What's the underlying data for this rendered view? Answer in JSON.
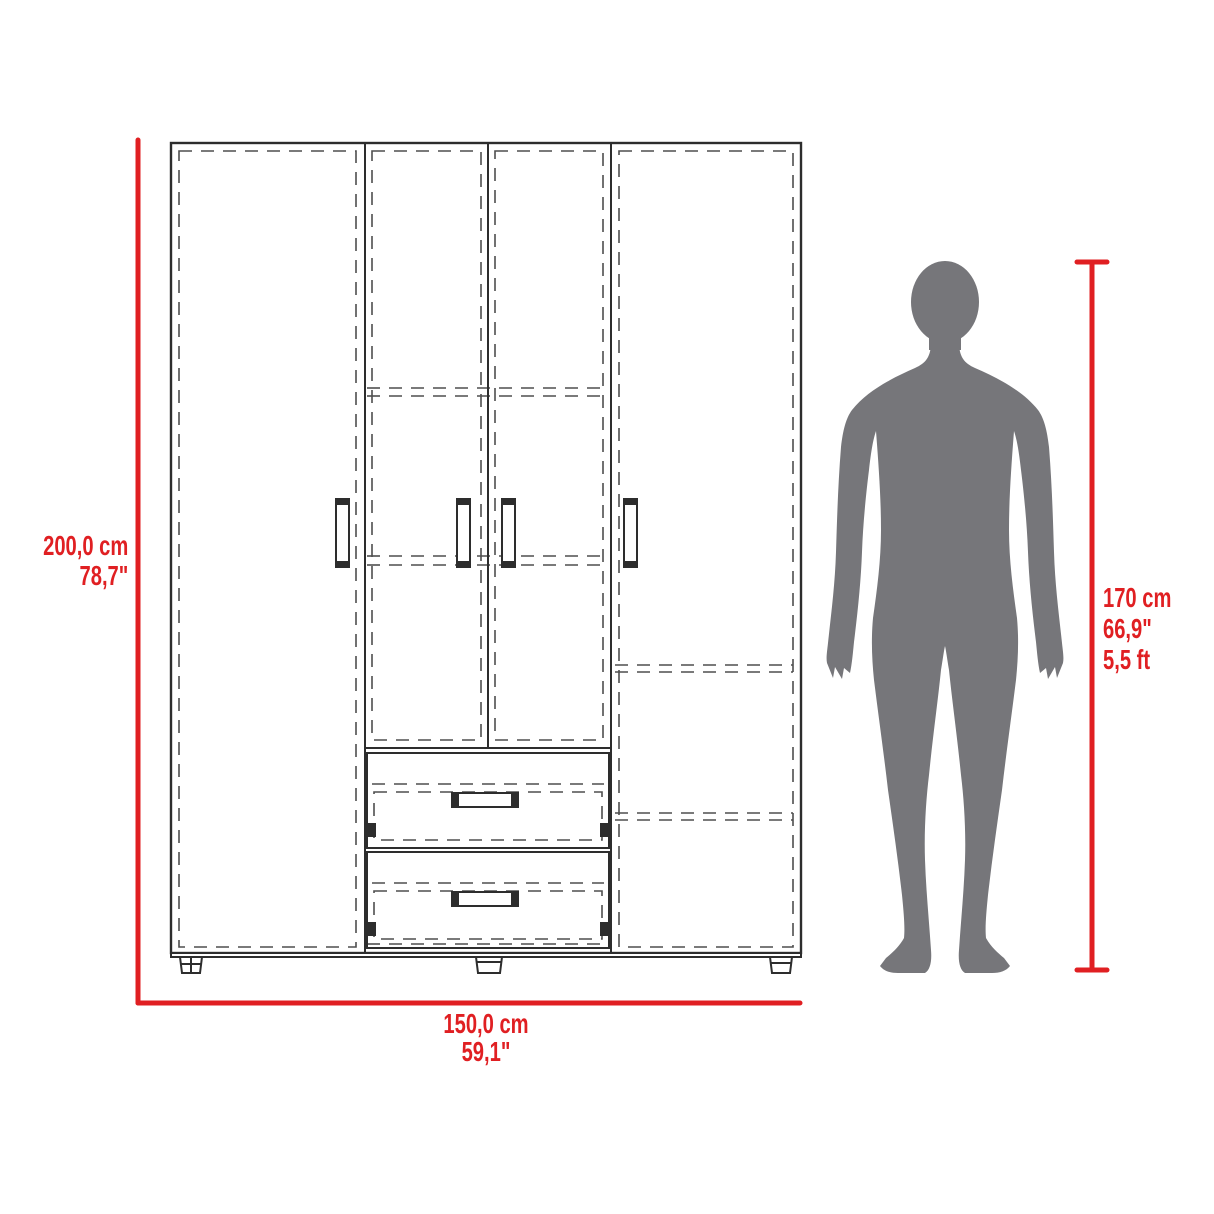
{
  "diagram": {
    "labels": {
      "height_cm": "200,0 cm",
      "height_in": "78,7\"",
      "width_cm": "150,0 cm",
      "width_in": "59,1\"",
      "person_cm": "170 cm",
      "person_in": "66,9\"",
      "person_ft": "5,5 ft"
    },
    "colors": {
      "dimension_red": "#e01f22",
      "silhouette_gray": "#76767a",
      "line_dark": "#2d2d2d",
      "line_dash": "#4e4e4e",
      "background": "#ffffff"
    },
    "icons": {
      "human_silhouette": "standing-man-silhouette"
    }
  }
}
